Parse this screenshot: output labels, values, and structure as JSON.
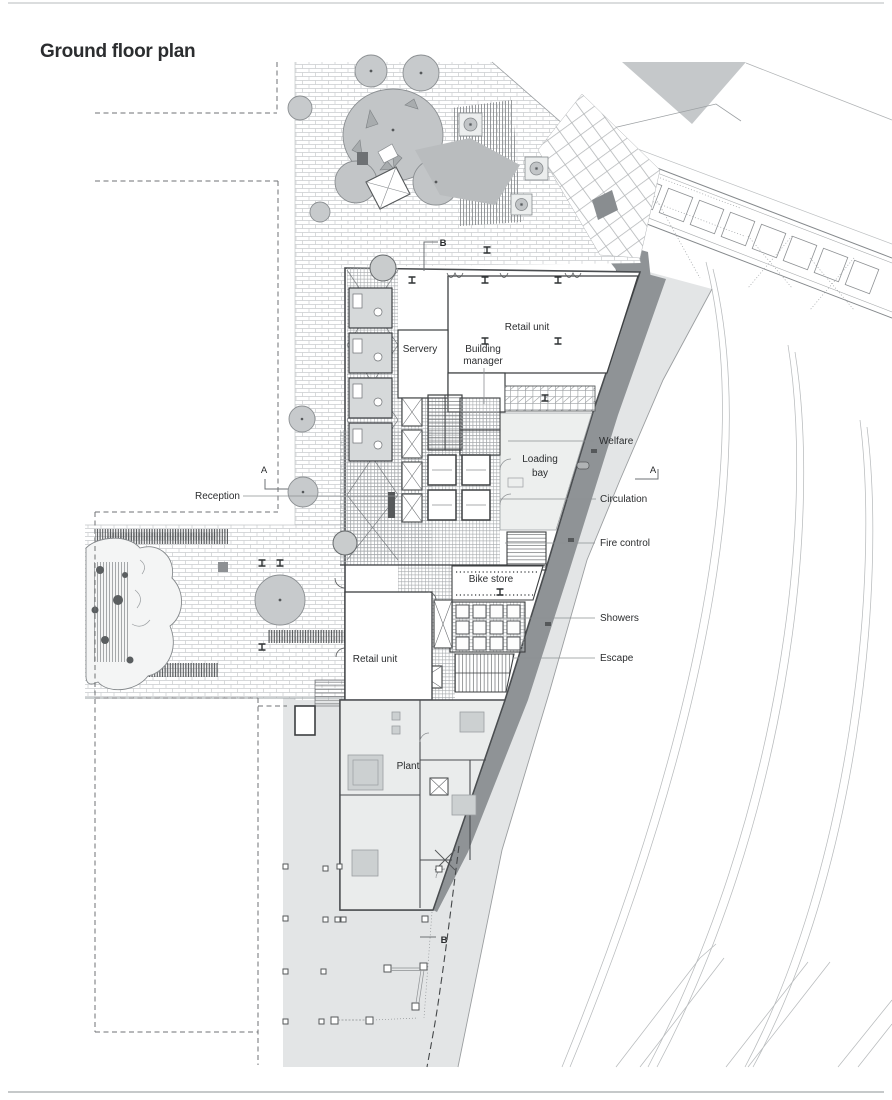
{
  "page": {
    "title": "Ground floor plan"
  },
  "plan": {
    "labels": {
      "retail_unit_top": "Retail unit",
      "servery": "Servery",
      "building_manager_line1": "Building",
      "building_manager_line2": "manager",
      "welfare": "Welfare",
      "loading_bay_line1": "Loading",
      "loading_bay_line2": "bay",
      "reception": "Reception",
      "circulation": "Circulation",
      "fire_control": "Fire control",
      "bike_store": "Bike store",
      "showers": "Showers",
      "escape": "Escape",
      "retail_unit_lower": "Retail unit",
      "plant": "Plant"
    },
    "section_markers": {
      "a": "A",
      "b": "B"
    },
    "colors": {
      "road": "#e3e5e6",
      "pavement_band": "#8f9396",
      "tree": "#c7cacc",
      "plant_room_fill": "#eaecec",
      "loading_bay_fill": "#edefee",
      "wall": "#3c3f41",
      "label_text": "#2b2d2f"
    }
  }
}
